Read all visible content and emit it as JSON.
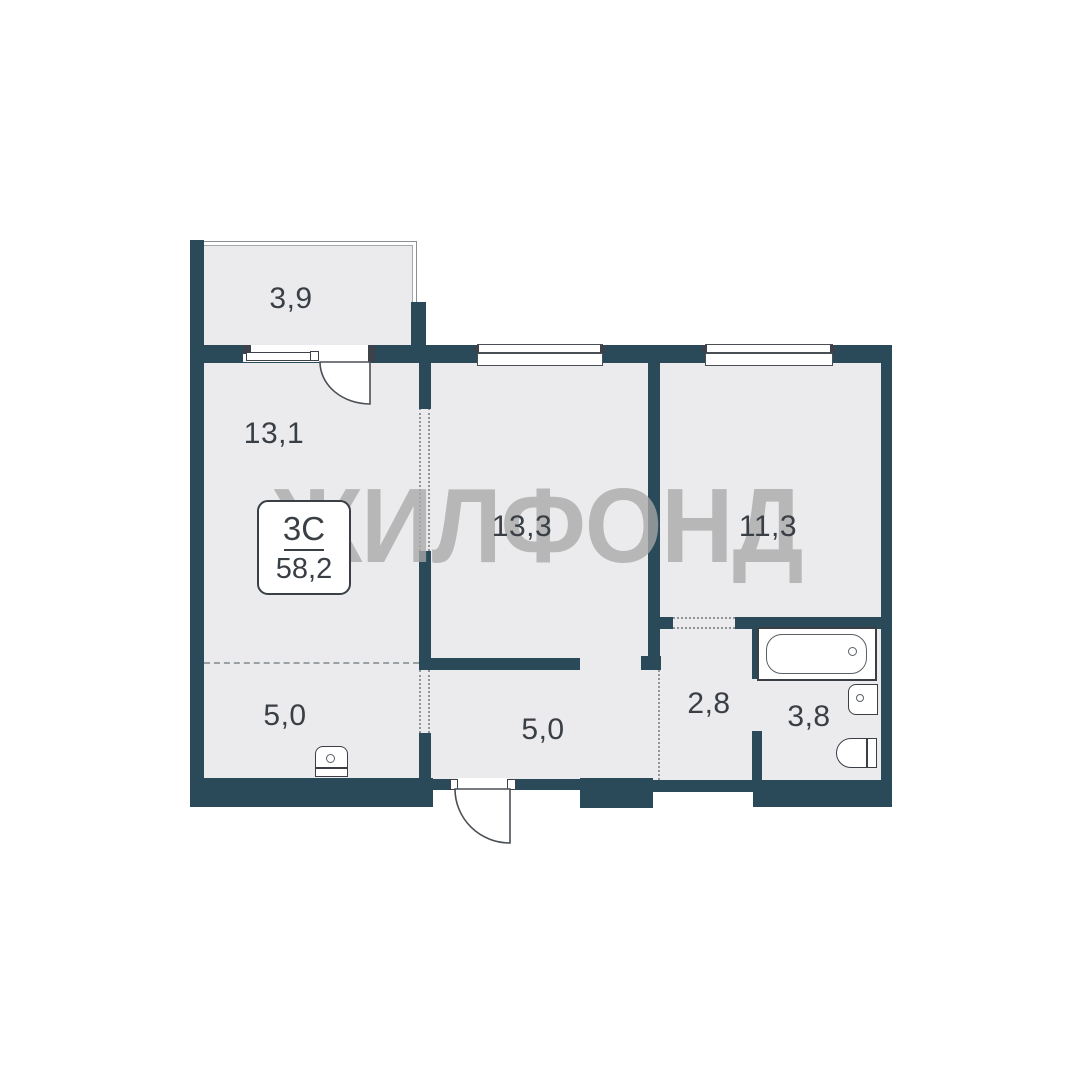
{
  "plan": {
    "watermark": "ЖИЛФОНД",
    "badge": {
      "type_label": "3С",
      "total_area": "58,2"
    },
    "rooms": [
      {
        "id": "balcony",
        "area": "3,9"
      },
      {
        "id": "room-13-1",
        "area": "13,1"
      },
      {
        "id": "room-13-3",
        "area": "13,3"
      },
      {
        "id": "room-11-3",
        "area": "11,3"
      },
      {
        "id": "corridor",
        "area": "2,8"
      },
      {
        "id": "bathroom",
        "area": "3,8"
      },
      {
        "id": "zone-left",
        "area": "5,0"
      },
      {
        "id": "entry-hall",
        "area": "5,0"
      }
    ],
    "colors": {
      "wall": "#2b4a59",
      "floor": "#ebebed",
      "outline": "#3d424a",
      "text": "#3a3f46",
      "watermark": "rgba(168,168,168,0.78)",
      "dashed_line": "#9aa0a4"
    },
    "fixtures": [
      "bathtub",
      "washbasin",
      "toilet",
      "sink"
    ]
  }
}
